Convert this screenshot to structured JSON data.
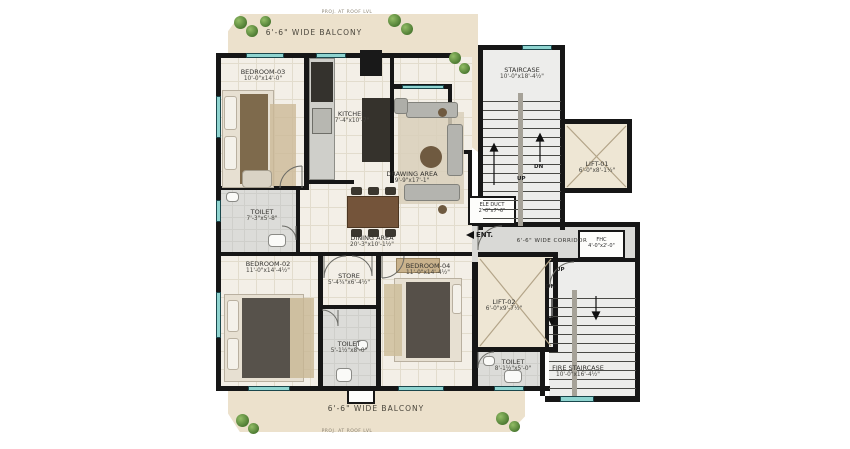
{
  "plan": {
    "balcony_top_label": "6'-6\" WIDE BALCONY",
    "balcony_bottom_label": "6'-6\" WIDE BALCONY",
    "proj_top": "PROJ. AT ROOF LVL",
    "proj_bottom": "PROJ. AT ROOF LVL",
    "rooms": {
      "bedroom3": {
        "name": "BEDROOM-03",
        "dims": "10'-0\"x14'-0\""
      },
      "kitchen": {
        "name": "KITCHEN",
        "dims": "7'-4\"x10'-7\""
      },
      "drawing": {
        "name": "DRAWING AREA",
        "dims": "9'-9\"x17'-1\""
      },
      "toilet1": {
        "name": "TOILET",
        "dims": "7'-3\"x5'-8\""
      },
      "dining": {
        "name": "DINING AREA",
        "dims": "20'-3\"x10'-1½\""
      },
      "bedroom2": {
        "name": "BEDROOM-02",
        "dims": "11'-0\"x14'-4½\""
      },
      "store": {
        "name": "STORE",
        "dims": "5'-4¾\"x6'-4½\""
      },
      "toilet2": {
        "name": "TOILET",
        "dims": "5'-1½\"x8'-0\""
      },
      "bedroom4": {
        "name": "BEDROOM-04",
        "dims": "11'-0\"x14'-4½\""
      },
      "staircase": {
        "name": "STAIRCASE",
        "dims": "10'-0\"x18'-4½\""
      },
      "lift1": {
        "name": "LIFT-01",
        "dims": "6'-0\"x8'-1½\""
      },
      "ele_duct": {
        "name": "ELE DUCT",
        "dims": "2'-0\"x7'-6\""
      },
      "corridor": {
        "name": "6'-6\" WIDE CORRIDOR"
      },
      "fhc": {
        "name": "FHC",
        "dims": "4'-0\"x2'-0\""
      },
      "lift2": {
        "name": "LIFT-02",
        "dims": "6'-0\"x9'-7½\""
      },
      "toilet3": {
        "name": "TOILET",
        "dims": "8'-1½\"x5'-0\""
      },
      "fire_staircase": {
        "name": "FIRE STAIRCASE",
        "dims": "10'-0\"x16'-4½\""
      }
    },
    "annotations": {
      "entrance": "ENT.",
      "up": "UP",
      "dn": "DN"
    }
  }
}
